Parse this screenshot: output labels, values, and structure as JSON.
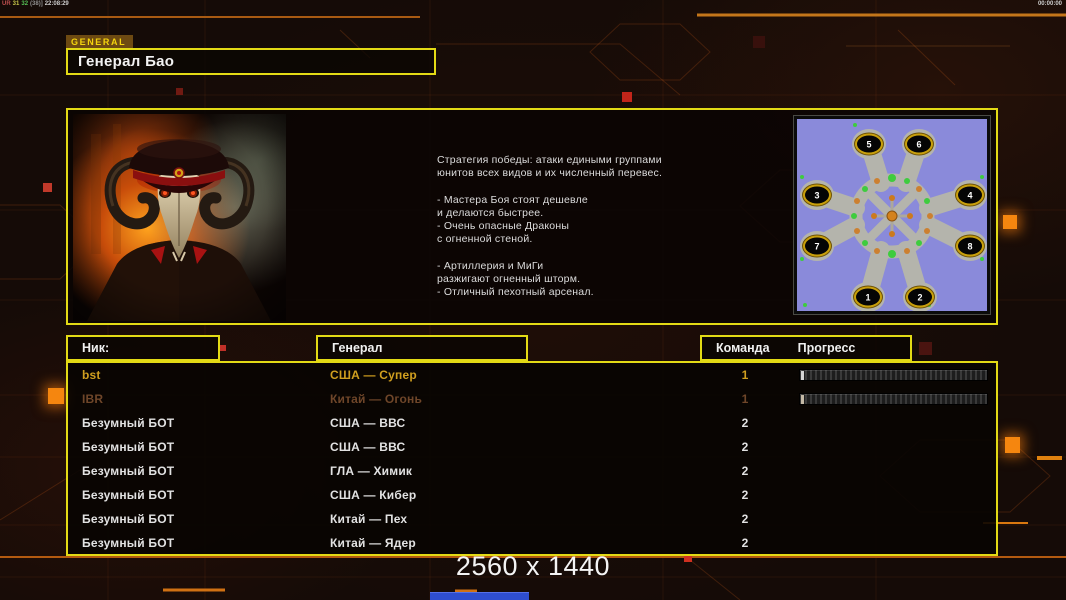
{
  "hud": {
    "stats_parts": {
      "p1": "UR",
      "p2": "31",
      "p3": "32",
      "p4": "(38)]",
      "p5": "22:08:29"
    },
    "timer": "00:00:00"
  },
  "header": {
    "tab": "GENERAL",
    "title": "Генерал Бао"
  },
  "info": {
    "portrait_icon": "general-bao-portrait",
    "strategy": "Стратегия победы: атаки едиными группами\nюнитов всех видов и их численный перевес.\n\n- Мастера Боя стоят дешевле\nи делаются быстрее.\n- Очень опасные Драконы\nс огненной стеной.\n\n- Артиллерия и МиГи\nразжигают огненный шторм.\n- Отличный пехотный арсенал.",
    "minimap_positions": [
      "1",
      "2",
      "3",
      "4",
      "5",
      "6",
      "7",
      "8"
    ]
  },
  "table": {
    "headers": {
      "nick": "Ник:",
      "general": "Генерал",
      "team": "Команда",
      "progress": "Прогресс"
    },
    "rows": [
      {
        "nick": "bst",
        "general": "США — Супер",
        "team": "1"
      },
      {
        "nick": "IBR",
        "general": "Китай — Огонь",
        "team": "1"
      },
      {
        "nick": "Безумный БОТ",
        "general": "США — ВВС",
        "team": "2"
      },
      {
        "nick": "Безумный БОТ",
        "general": "США — ВВС",
        "team": "2"
      },
      {
        "nick": "Безумный БОТ",
        "general": "ГЛА — Химик",
        "team": "2"
      },
      {
        "nick": "Безумный БОТ",
        "general": "США — Кибер",
        "team": "2"
      },
      {
        "nick": "Безумный БОТ",
        "general": "Китай — Пех",
        "team": "2"
      },
      {
        "nick": "Безумный БОТ",
        "general": "Китай — Ядер",
        "team": "2"
      }
    ]
  },
  "footer": {
    "resolution": "2560 x 1440"
  },
  "colors": {
    "accent_yellow": "#e3da15",
    "gold_player_text": "#d09f1f",
    "dim_player_text": "#6f4629",
    "accent_orange": "#f5860f",
    "minimap_water": "#8a8ada"
  }
}
